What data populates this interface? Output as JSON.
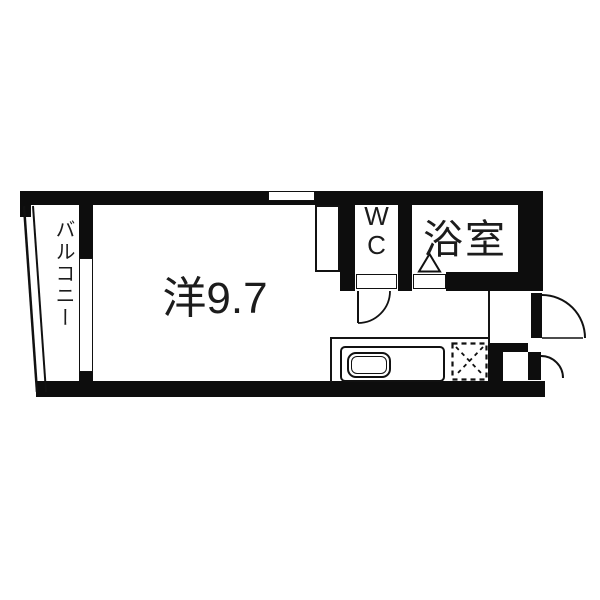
{
  "plan": {
    "type": "apartment-floor-plan",
    "colors": {
      "wall": "#0d0d0d",
      "floor": "#ffffff",
      "line": "#151515"
    },
    "rooms": {
      "balcony": {
        "label": "バルコニー"
      },
      "main": {
        "label": "洋9.7",
        "size_tatami": "9.7"
      },
      "wc": {
        "label": "W C"
      },
      "bathroom": {
        "label": "浴室"
      }
    }
  }
}
